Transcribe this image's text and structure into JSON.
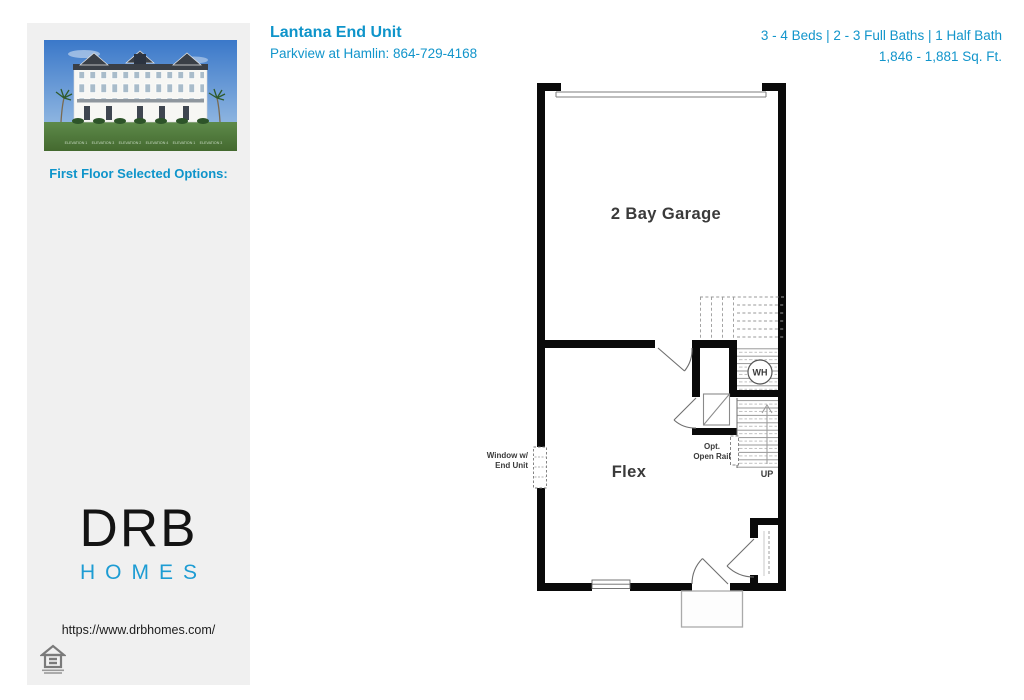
{
  "header": {
    "title": "Lantana End Unit",
    "subtitle": "Parkview at Hamlin: 864-729-4168",
    "specs_line1": "3 - 4 Beds | 2 - 3 Full Baths | 1 Half Bath",
    "specs_line2": "1,846 - 1,881 Sq. Ft."
  },
  "sidebar": {
    "selected_options_label": "First Floor Selected Options:",
    "elevation_labels": [
      "ELEVATION 1",
      "ELEVATION 3",
      "ELEVATION 2",
      "ELEVATION 4",
      "ELEVATION 1",
      "ELEVATION 3"
    ],
    "logo": {
      "brand": "DRB",
      "sub": "HOMES"
    },
    "website": "https://www.drbhomes.com/"
  },
  "floorplan": {
    "rooms": {
      "garage": "2 Bay Garage",
      "flex": "Flex"
    },
    "labels": {
      "water_heater": "WH",
      "up": "UP",
      "opt_line1": "Opt.",
      "opt_line2": "Open Rail",
      "window_line1": "Window w/",
      "window_line2": "End Unit"
    }
  },
  "colors": {
    "accent": "#0e94ca",
    "wall": "#0a0a0a"
  }
}
